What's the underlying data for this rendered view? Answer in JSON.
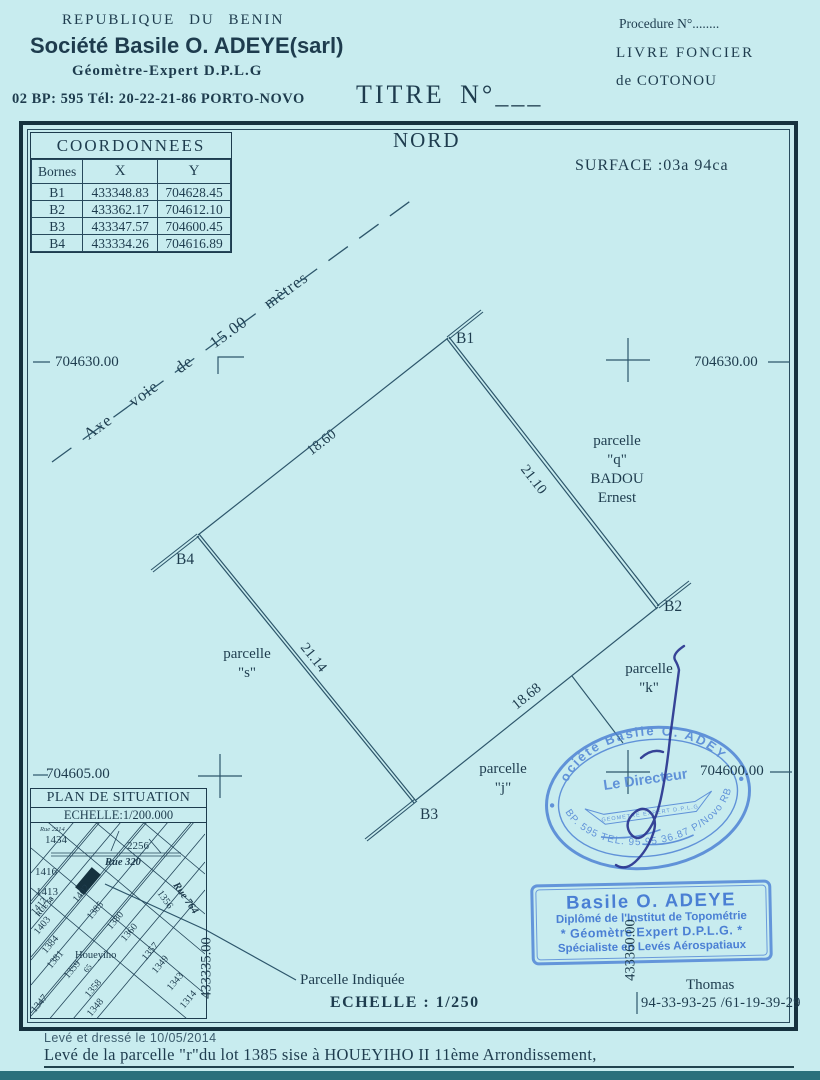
{
  "colors": {
    "paper": "#c8ecef",
    "ink": "#1e3c4e",
    "line": "#2d566b",
    "stamp_blue": "#4a7fd4",
    "signature_blue": "#2a3590"
  },
  "letterhead": {
    "country": "REPUBLIQUE DU BENIN",
    "company": "Société Basile O. ADEYE(sarl)",
    "profession": "Géomètre-Expert D.P.L.G",
    "address": "02 BP: 595 Tél: 20-22-21-86  PORTO-NOVO",
    "procedure": "Procedure N°........",
    "registry_book": "LIVRE FONCIER",
    "registry_city": "de COTONOU",
    "title": "TITRE  N°___"
  },
  "plan": {
    "north_label": "NORD",
    "surface_label": "SURFACE :03a 94ca",
    "axis_words": [
      "Axe",
      "voie",
      "de",
      "15.00",
      "mètres"
    ],
    "corners": {
      "b1": "B1",
      "b2": "B2",
      "b3": "B3",
      "b4": "B4"
    },
    "sides": {
      "b1_b4": "18.60",
      "b1_b2": "21.10",
      "b4_b3": "21.14",
      "b3_b2": "18.68"
    },
    "neighbor_q": [
      "parcelle",
      "\"q\"",
      "BADOU",
      "Ernest"
    ],
    "neighbor_s": [
      "parcelle",
      "\"s\""
    ],
    "neighbor_k": [
      "parcelle",
      "\"k\""
    ],
    "neighbor_j": [
      "parcelle",
      "\"j\""
    ],
    "grid": {
      "y_top_left": "704630.00",
      "y_top_right": "704630.00",
      "y_bottom_left": "704605.00",
      "y_bottom_right": "704600.00",
      "x_left": "433335.00",
      "x_right": "433360.00"
    }
  },
  "coordinates_table": {
    "title": "COORDONNEES",
    "headers": [
      "Bornes",
      "X",
      "Y"
    ],
    "rows": [
      [
        "B1",
        "433348.83",
        "704628.45"
      ],
      [
        "B2",
        "433362.17",
        "704612.10"
      ],
      [
        "B3",
        "433347.57",
        "704600.45"
      ],
      [
        "B4",
        "433334.26",
        "704616.89"
      ]
    ]
  },
  "situation_plan": {
    "title": "PLAN DE SITUATION",
    "scale": "ECHELLE:1/200.000",
    "area": "Houeyiho",
    "streets": [
      "Rue 320",
      "Rue 764",
      "RUE 58",
      "Rue 2214"
    ],
    "lots": [
      "1434",
      "2256",
      "1416",
      "1413",
      "1412",
      "1403",
      "1402",
      "1385",
      "1380",
      "1360",
      "1356",
      "1384",
      "1381",
      "1359",
      "65",
      "1358",
      "1348",
      "1347",
      "1357",
      "1349",
      "1343",
      "1314"
    ]
  },
  "callout": {
    "label": "Parcelle Indiquée",
    "scale": "ECHELLE : 1/250"
  },
  "stamps": {
    "oval": {
      "arc_top": "Société Basile O. ADEYE",
      "center": "Le Directeur",
      "center_small": "GEOMETRE EXPERT D.P.L.G",
      "arc_bottom": "BP. 595 TEL. 95 95 36.87 P/Novo RB"
    },
    "rect": {
      "name": "Basile O. ADEYE",
      "line2": "Diplômé de l'Institut de Topométrie",
      "line3": "* Géomètre Expert D.P.L.G. *",
      "line4": "Spécialiste en Levés Aérospatiaux"
    }
  },
  "contact": {
    "name": "Thomas",
    "phones": "94-33-93-25 /61-19-39-29"
  },
  "footer": {
    "surveyed": "Levé et dressé le 10/05/2014",
    "description": "Levé de la parcelle \"r\"du lot 1385 sise à HOUEYIHO II 11ème Arrondissement,"
  }
}
